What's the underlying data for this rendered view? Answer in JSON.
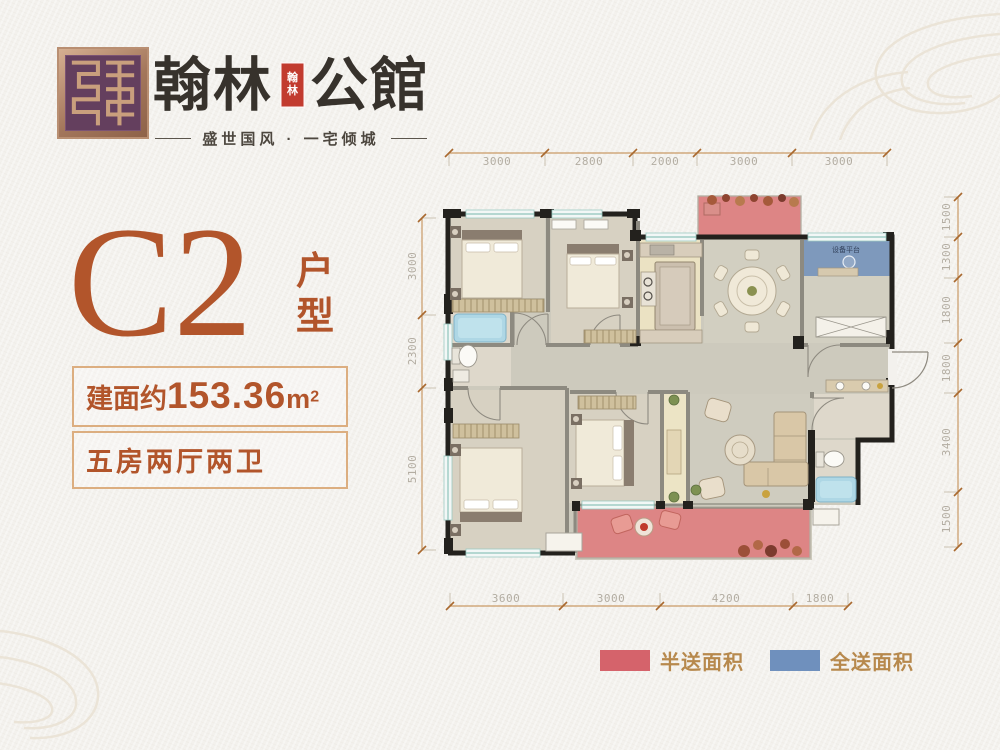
{
  "brand": {
    "seal_icon": "maze-seal-icon",
    "name_left": "翰林",
    "name_right": "公館",
    "mini_seal_top": "翰",
    "mini_seal_bottom": "林",
    "tagline": "盛世国风 · 一宅倾城"
  },
  "unit": {
    "code": "C2",
    "type_char_1": "户",
    "type_char_2": "型"
  },
  "specs": {
    "area_prefix": "建面约",
    "area_value": "153.36",
    "area_unit_base": "m",
    "area_unit_sup": "2",
    "layout": "五房两厅两卫"
  },
  "plan": {
    "dims_top": [
      "3000",
      "2800",
      "2000",
      "3000",
      "3000"
    ],
    "dims_bottom": [
      "3600",
      "3000",
      "4200",
      "1800"
    ],
    "dims_left": [
      "3000",
      "2300",
      "5100"
    ],
    "dims_right": [
      "1500",
      "1300",
      "1800",
      "1800",
      "3400",
      "1500"
    ],
    "room_labels": {
      "equipment": "设备平台"
    }
  },
  "legend": {
    "items": [
      {
        "label": "半送面积",
        "color": "#d5636b"
      },
      {
        "label": "全送面积",
        "color": "#6f90bd"
      }
    ]
  },
  "colors": {
    "paper": "#f3f1ed",
    "accent": "#b2552b",
    "brand_ink": "#37322c",
    "seal_red": "#c23b2f",
    "banner_border": "#dcae80",
    "legend_text": "#b7894d",
    "dim_line": "#c99a66",
    "dim_tick": "#a9692f",
    "dim_text": "#b3ada2",
    "wall": "#23211d",
    "half_gift_area": "#dd8585",
    "full_gift_area": "#7e99bc"
  }
}
